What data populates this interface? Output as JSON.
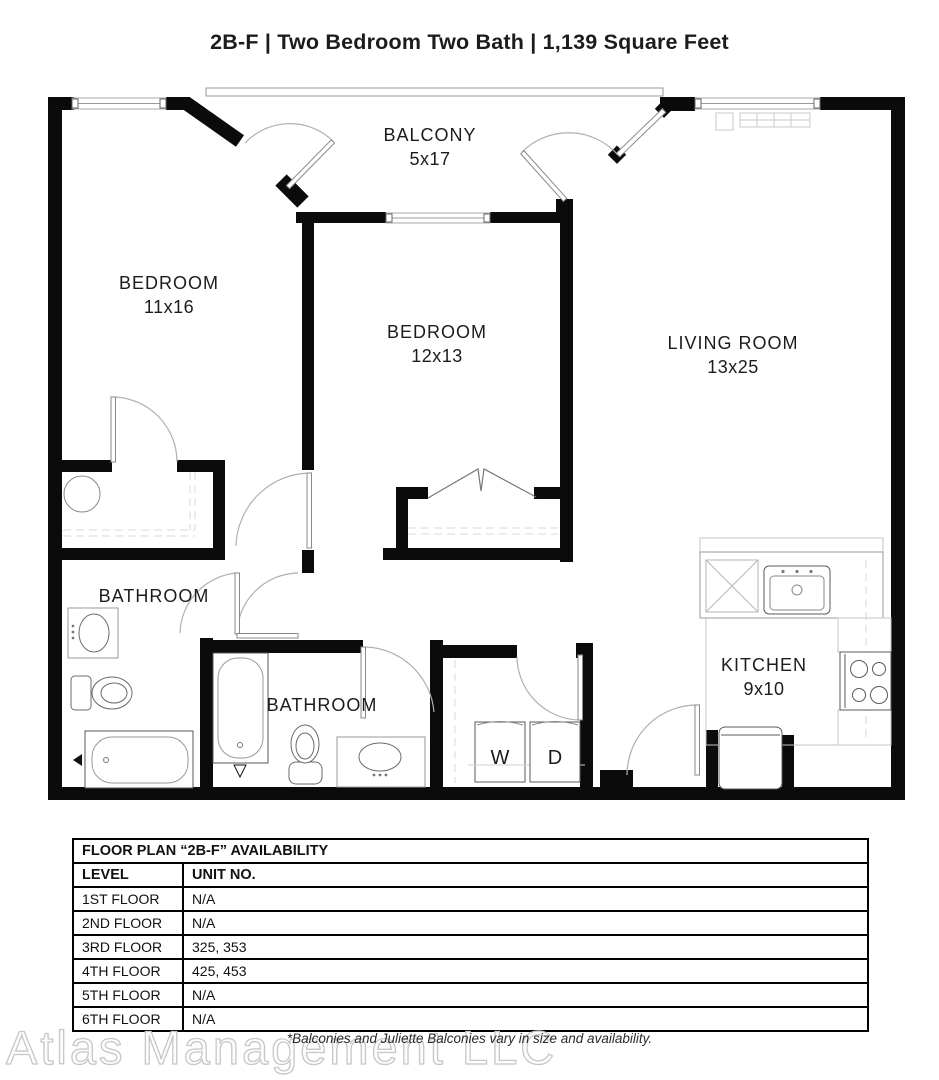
{
  "header": {
    "title": "2B-F | Two Bedroom Two Bath | 1,139 Square Feet"
  },
  "plan": {
    "balcony": {
      "name": "BALCONY",
      "dims": "5x17"
    },
    "bedroom1": {
      "name": "BEDROOM",
      "dims": "11x16"
    },
    "bedroom2": {
      "name": "BEDROOM",
      "dims": "12x13"
    },
    "living_room": {
      "name": "LIVING ROOM",
      "dims": "13x25"
    },
    "kitchen": {
      "name": "KITCHEN",
      "dims": "9x10"
    },
    "bathroom1": {
      "name": "BATHROOM"
    },
    "bathroom2": {
      "name": "BATHROOM"
    },
    "washer": "W",
    "dryer": "D"
  },
  "availability_table": {
    "title": "FLOOR PLAN “2B-F” AVAILABILITY",
    "columns": [
      "LEVEL",
      "UNIT NO."
    ],
    "rows": [
      {
        "level": "1ST FLOOR",
        "unit_no": "N/A"
      },
      {
        "level": "2ND FLOOR",
        "unit_no": "N/A"
      },
      {
        "level": "3RD FLOOR",
        "unit_no": "325, 353"
      },
      {
        "level": "4TH FLOOR",
        "unit_no": "425, 453"
      },
      {
        "level": "5TH FLOOR",
        "unit_no": "N/A"
      },
      {
        "level": "6TH FLOOR",
        "unit_no": "N/A"
      }
    ]
  },
  "footer": {
    "note": "*Balconies and Juliette Balconies vary in size and availability.",
    "watermark": "Atlas Management LLC"
  },
  "colors": {
    "wall": "#0b0b0b",
    "fixture": "#5a5a5a",
    "light_line": "#c4c4c4",
    "arc": "#b0b0b0"
  }
}
